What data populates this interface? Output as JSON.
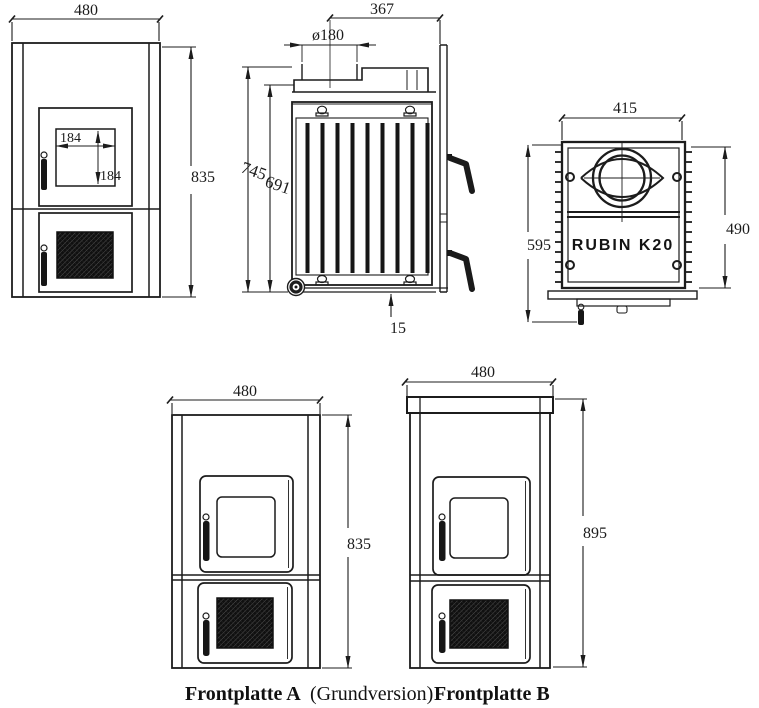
{
  "document": {
    "type": "technical-drawing",
    "subject": "RUBIN K20 stove dimensional drawing"
  },
  "colors": {
    "line": "#1c1c1c",
    "background": "#ffffff",
    "dark_fill": "#161616"
  },
  "views": {
    "front": {
      "width": "480",
      "height": "835",
      "glass_width": "184",
      "glass_height": "184"
    },
    "side": {
      "depth": "367",
      "flue_diameter": "ø180",
      "height_total": "745",
      "height_inner": "691",
      "base_gap": "15"
    },
    "top": {
      "width": "415",
      "depth_total": "595",
      "depth_body": "490",
      "model": "RUBIN K20"
    },
    "plate_a": {
      "width": "480",
      "height": "835"
    },
    "plate_b": {
      "width": "480",
      "height": "895"
    }
  },
  "caption": {
    "label_a": "Frontplatte A",
    "note": "(Grundversion)",
    "label_b": "Frontplatte B"
  }
}
